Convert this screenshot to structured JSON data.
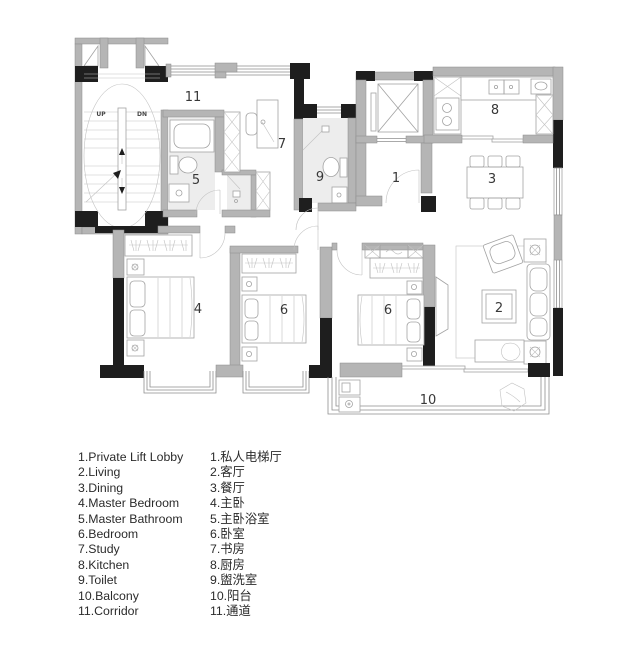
{
  "plan": {
    "room_numbers": {
      "r1": "1",
      "r2": "2",
      "r3": "3",
      "r4": "4",
      "r5": "5",
      "r6a": "6",
      "r6b": "6",
      "r7": "7",
      "r8": "8",
      "r9": "9",
      "r10": "10",
      "r11": "11"
    },
    "stair": {
      "up": "UP",
      "down": "DN"
    }
  },
  "legend": {
    "english": [
      "1.Private Lift Lobby",
      "2.Living",
      "3.Dining",
      "4.Master Bedroom",
      "5.Master Bathroom",
      "6.Bedroom",
      "7.Study",
      "8.Kitchen",
      "9.Toilet",
      "10.Balcony",
      "11.Corridor"
    ],
    "chinese": [
      "1.私人电梯厅",
      "2.客厅",
      "3.餐厅",
      "4.主卧",
      "5.主卧浴室",
      "6.卧室",
      "7.书房",
      "8.厨房",
      "9.盥洗室",
      "10.阳台",
      "11.通道"
    ]
  },
  "colors": {
    "wall_gray": "#b5b5b5",
    "column_black": "#1e1e1e",
    "furniture_line": "#a3a3a3",
    "floor_tint": "#ededed",
    "text": "#2b2b2b"
  }
}
